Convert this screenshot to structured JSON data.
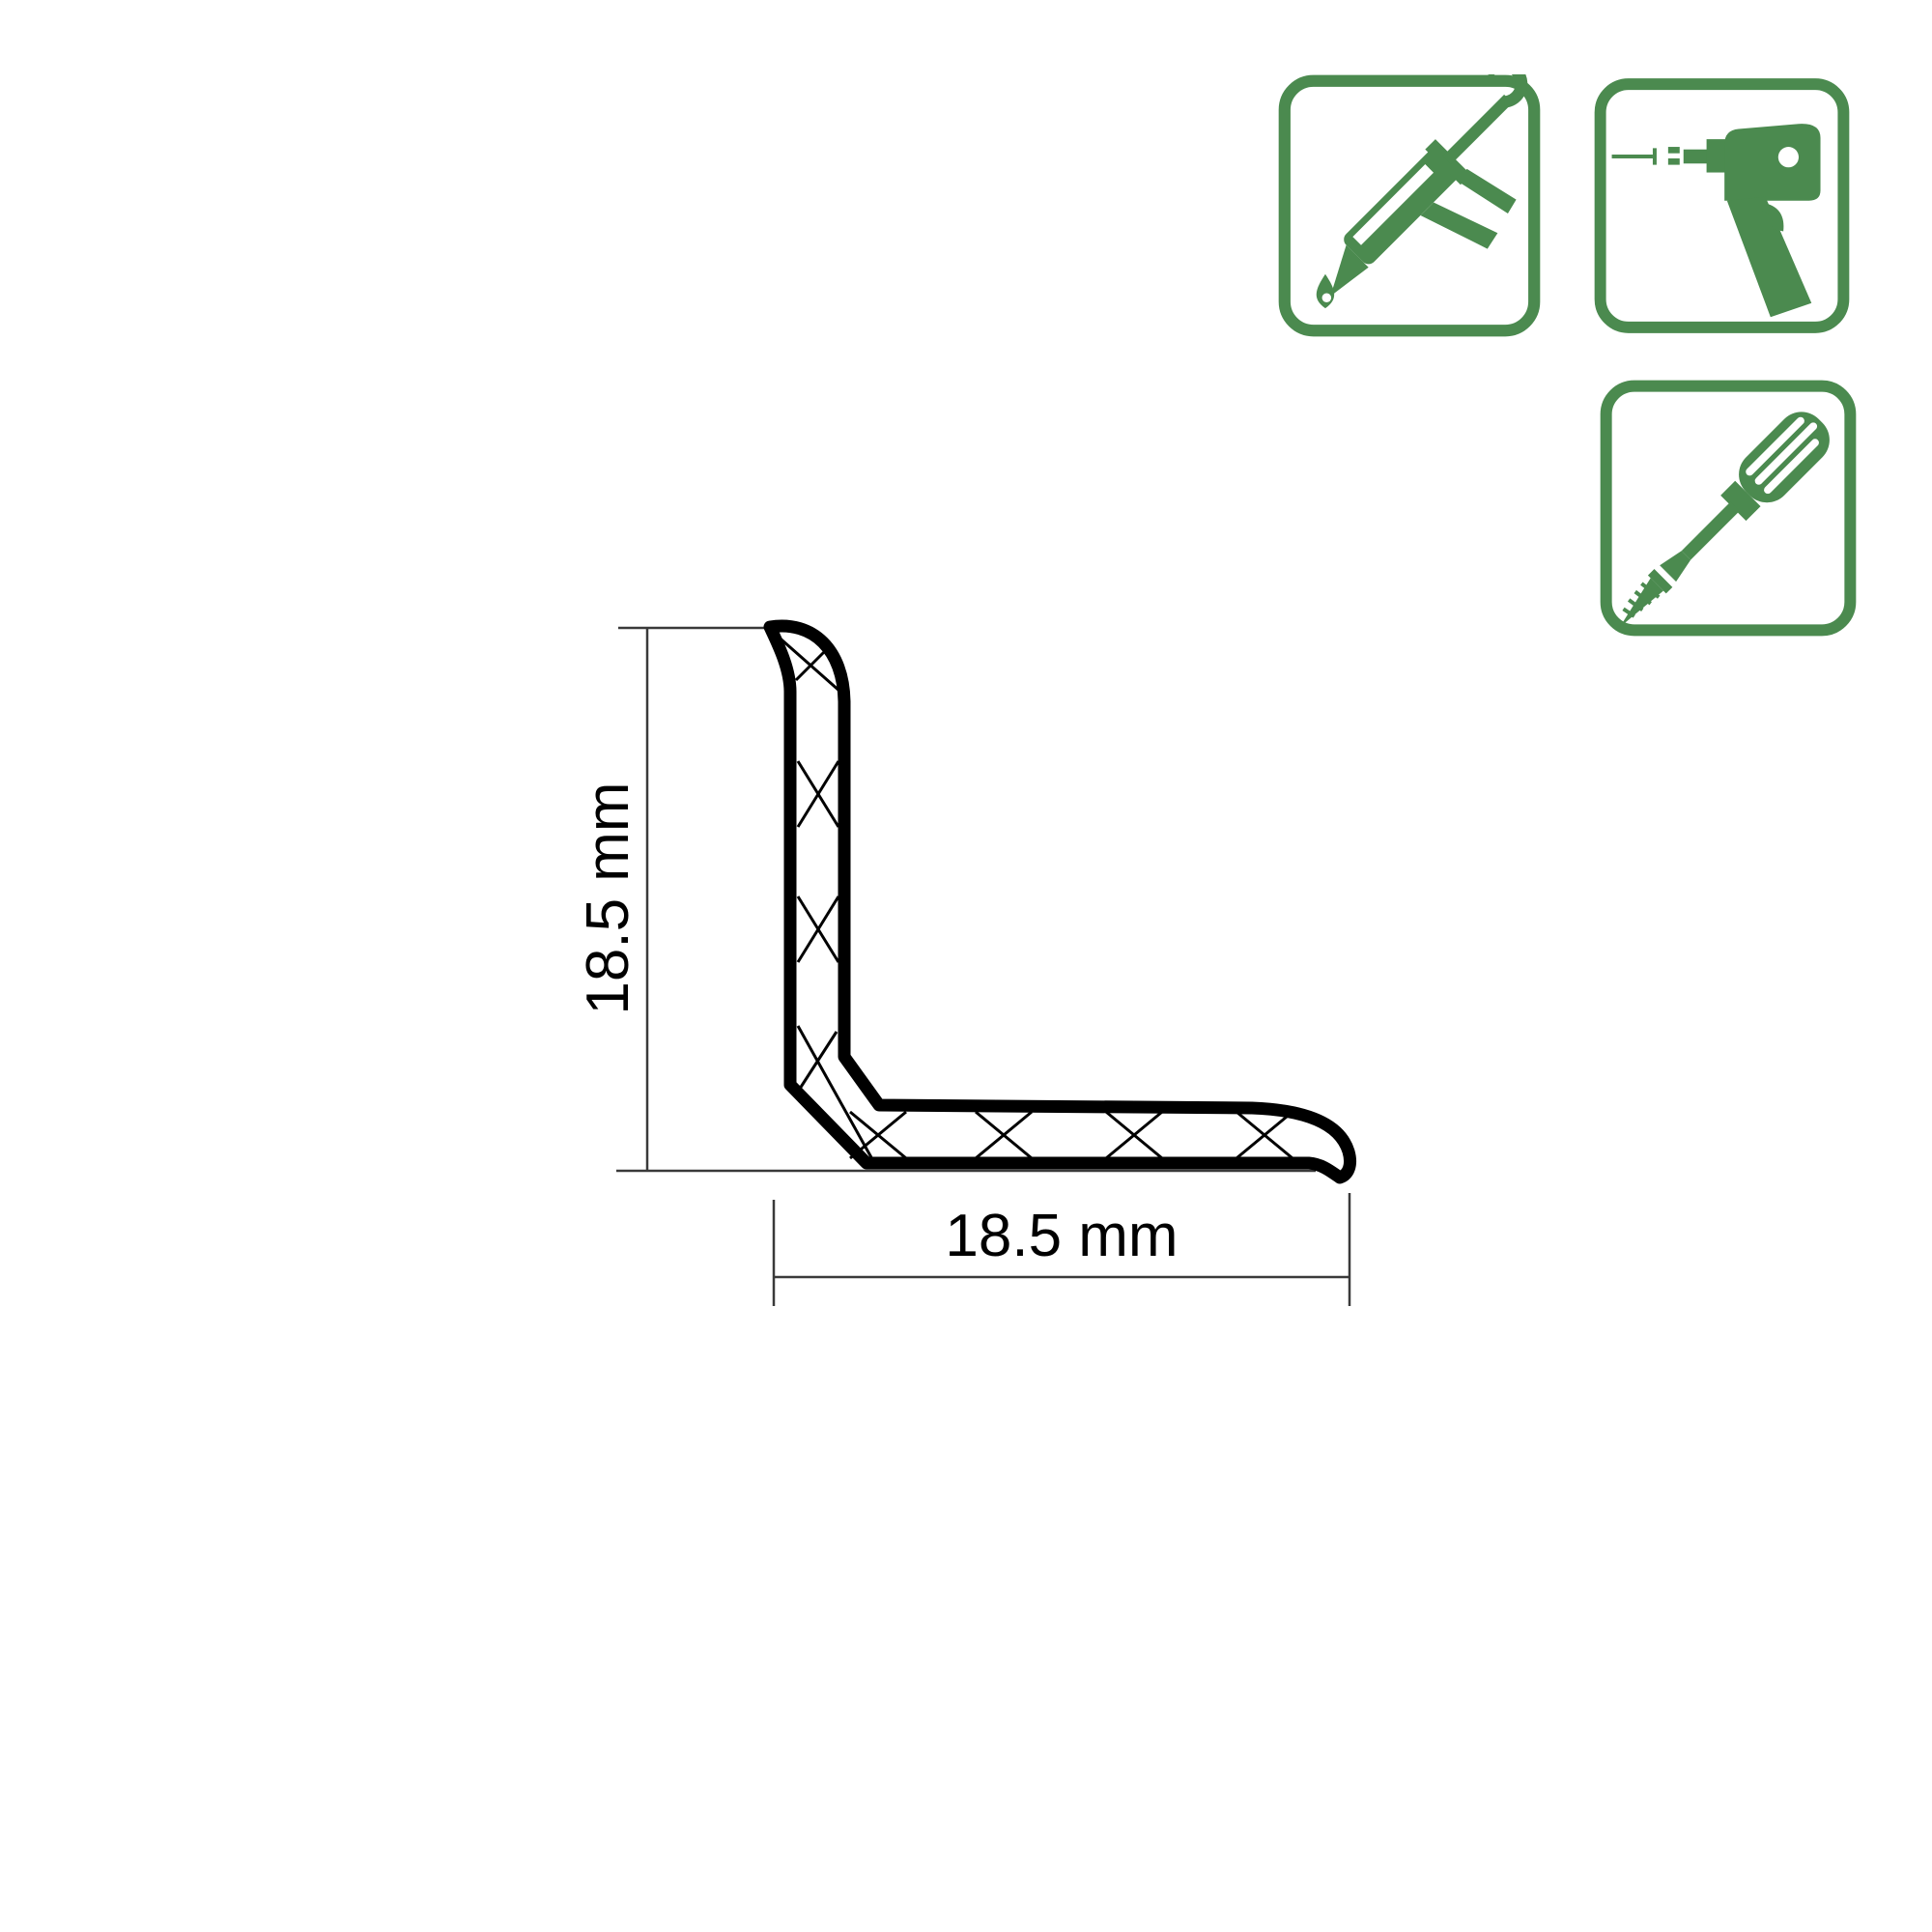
{
  "page": {
    "type": "product-technical-diagram"
  },
  "colors": {
    "background": "#ffffff",
    "accent_green": "#4b8a4f",
    "profile_line": "#000000",
    "dimension_line": "#3a3a3a"
  },
  "diagram": {
    "description": "L-shaped PVC profile cross-section with crosshatch, hooked top lip and curled bottom-right lip",
    "vertical_dimension": {
      "label": "18.5 mm"
    },
    "horizontal_dimension": {
      "label": "18.5 mm"
    }
  },
  "installation_badges": {
    "items": [
      {
        "icon": "caulking-gun-icon",
        "meaning": "adhesive-mounting"
      },
      {
        "icon": "nail-gun-icon",
        "meaning": "nail-mounting"
      },
      {
        "icon": "screwdriver-icon",
        "meaning": "screw-mounting"
      }
    ]
  }
}
